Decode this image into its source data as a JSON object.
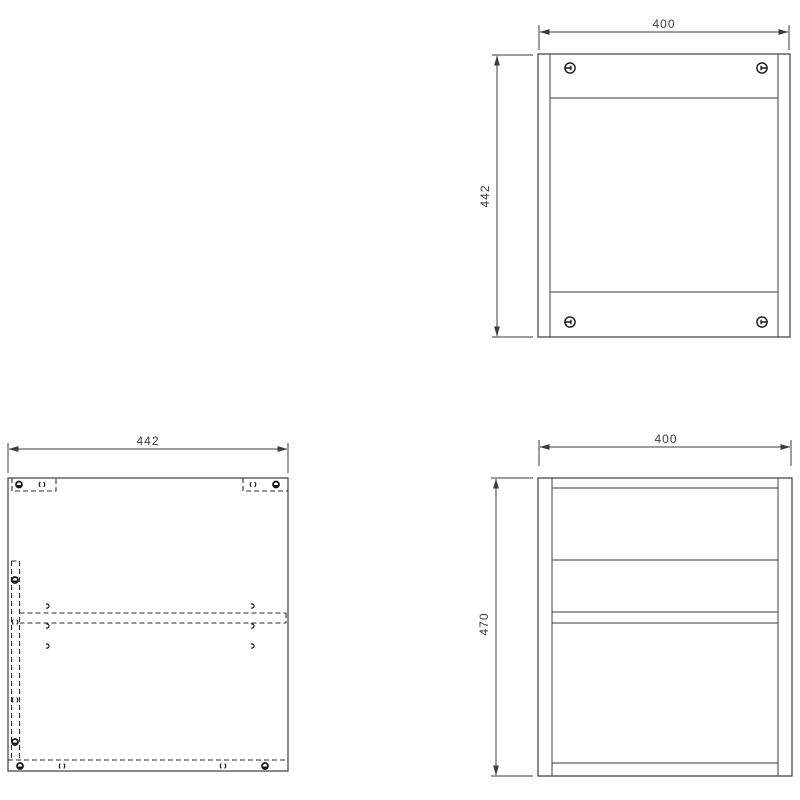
{
  "page": {
    "background": "#ffffff",
    "line_color": "#3d3d3d",
    "symbol_color": "#161616",
    "description": "Orthographic assembly drawing of a cabinet carcass, three views with millimetre dimensions"
  },
  "drawing": {
    "views": {
      "top_view": {
        "name": "top view",
        "dim_width": "400",
        "dim_depth": "442",
        "fasteners": [
          "cam-screw",
          "cam-screw",
          "cam-screw",
          "cam-screw"
        ]
      },
      "side_panel_view": {
        "name": "side panel inside face",
        "dim_width": "442",
        "hidden_feature_symbols": [
          "cam-lock",
          "dowel-pin",
          "screw-hole"
        ]
      },
      "front_view": {
        "name": "front view",
        "dim_width": "400",
        "dim_height": "470"
      }
    }
  }
}
